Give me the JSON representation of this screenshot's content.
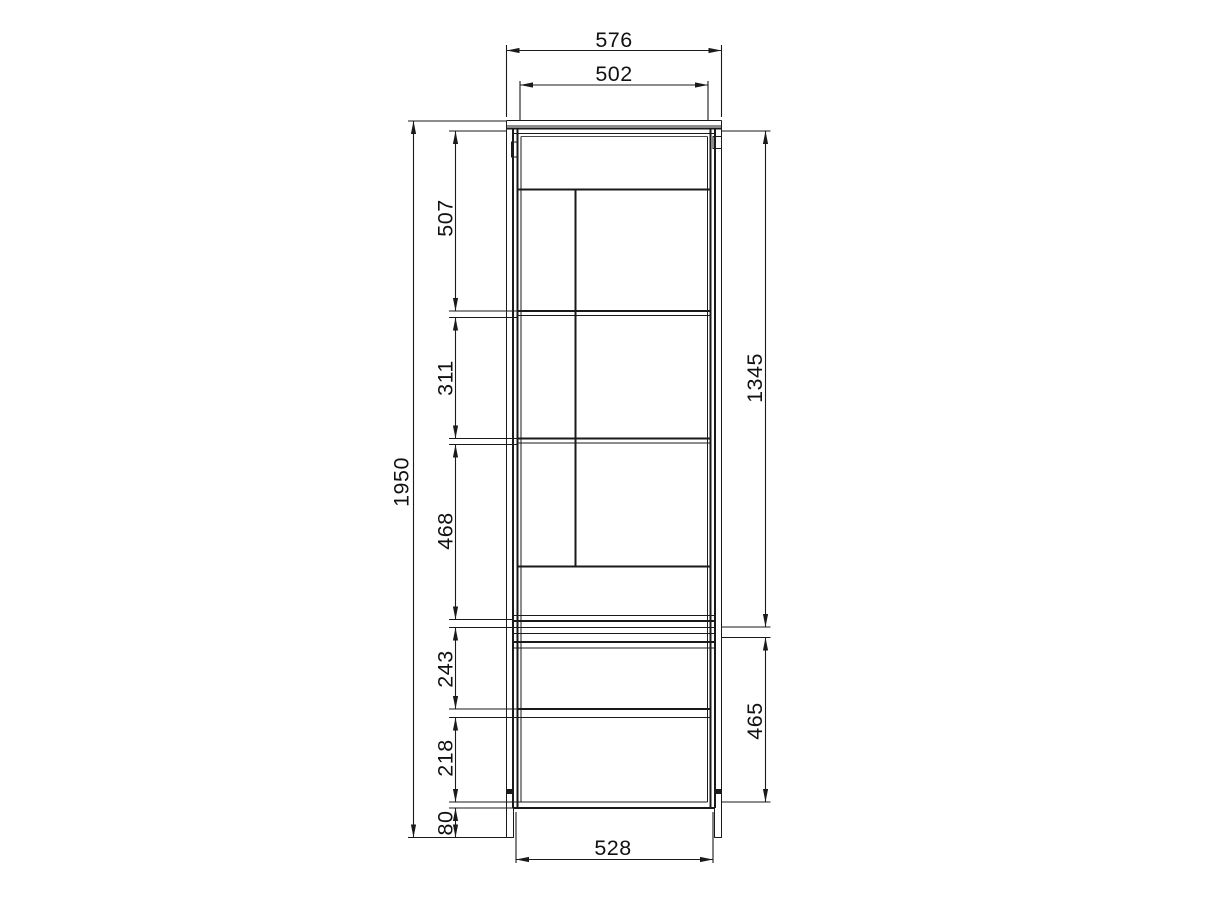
{
  "page": {
    "background": "#ffffff",
    "content_type": "furniture-technical-drawing",
    "subject": "tall display cabinet front elevation with dimension chains",
    "unit": "mm"
  },
  "drawing": {
    "line_color": "#1a1a1a",
    "parts": [
      "top-panel",
      "left-side",
      "right-side",
      "top-hinge-left",
      "top-block-right",
      "door-frame",
      "door-divider",
      "shelf-upper",
      "shelf-lower",
      "door-bottom-rail",
      "mid-divider-band",
      "drawer-rail",
      "bottom-panel",
      "left-leg",
      "right-leg"
    ]
  },
  "dimensions": {
    "top_width": {
      "value": 576,
      "label": "576",
      "orientation": "horizontal",
      "position": "top-outer"
    },
    "door_width": {
      "value": 502,
      "label": "502",
      "orientation": "horizontal",
      "position": "top-inner"
    },
    "total_height": {
      "value": 1950,
      "label": "1950",
      "orientation": "vertical",
      "position": "far-left"
    },
    "upper_section": {
      "value": 507,
      "label": "507",
      "orientation": "vertical",
      "position": "left-chain-1"
    },
    "middle_section": {
      "value": 311,
      "label": "311",
      "orientation": "vertical",
      "position": "left-chain-2"
    },
    "lower_section": {
      "value": 468,
      "label": "468",
      "orientation": "vertical",
      "position": "left-chain-3"
    },
    "drawer_upper": {
      "value": 243,
      "label": "243",
      "orientation": "vertical",
      "position": "left-chain-4"
    },
    "drawer_lower": {
      "value": 218,
      "label": "218",
      "orientation": "vertical",
      "position": "left-chain-5"
    },
    "plinth_height": {
      "value": 80,
      "label": "80",
      "orientation": "vertical",
      "position": "left-chain-6"
    },
    "door_height": {
      "value": 1345,
      "label": "1345",
      "orientation": "vertical",
      "position": "right-upper"
    },
    "base_height": {
      "value": 465,
      "label": "465",
      "orientation": "vertical",
      "position": "right-lower"
    },
    "base_width": {
      "value": 528,
      "label": "528",
      "orientation": "horizontal",
      "position": "bottom"
    }
  }
}
